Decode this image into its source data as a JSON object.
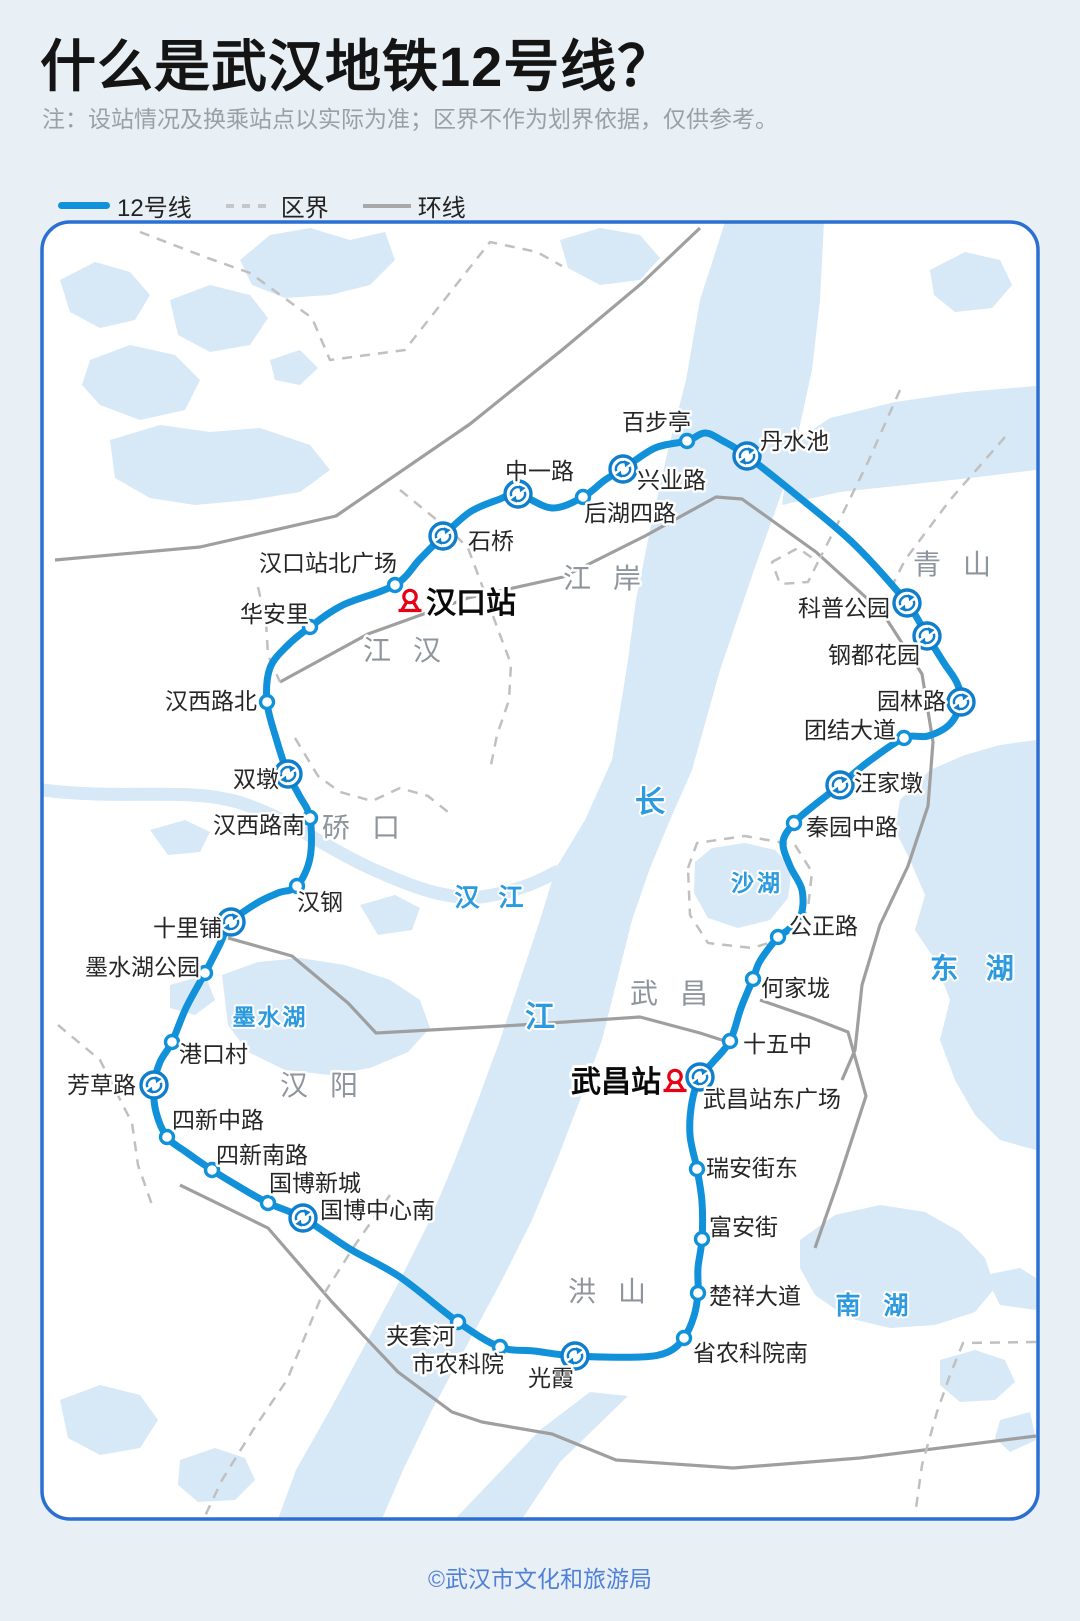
{
  "page": {
    "width": 1080,
    "height": 1621
  },
  "header": {
    "title": "什么是武汉地铁12号线？",
    "note": "注：设站情况及换乘站点以实际为准；区界不作为划界依据，仅供参考。"
  },
  "legend": {
    "items": [
      {
        "label": "12号线",
        "swatch": "line"
      },
      {
        "label": "区界",
        "swatch": "dashed"
      },
      {
        "label": "环线",
        "swatch": "ring-road"
      }
    ]
  },
  "footer": {
    "credit": "©武汉市文化和旅游局"
  },
  "colors": {
    "line": "#1191d9",
    "transfer_icon": "#0f7ecc",
    "map_border": "#2a6fd1",
    "water": "#d7e8f7",
    "road": "#9f9f9f",
    "boundary_dash": "#c0c0c0",
    "water_label": "#2b9ade",
    "district_label": "#8e959c",
    "railway_red": "#e60113",
    "footer_text": "#4f81d8",
    "background": "#e9f0f5"
  },
  "map": {
    "districts": [
      {
        "name": "江岸",
        "x": 613,
        "y": 588
      },
      {
        "name": "江汉",
        "x": 413,
        "y": 660
      },
      {
        "name": "硚口",
        "x": 372,
        "y": 837
      },
      {
        "name": "汉阳",
        "x": 330,
        "y": 1095
      },
      {
        "name": "武昌",
        "x": 680,
        "y": 1003
      },
      {
        "name": "洪山",
        "x": 618,
        "y": 1301
      },
      {
        "name": "青山",
        "x": 963,
        "y": 574
      }
    ],
    "water_labels": [
      {
        "name": "长",
        "x": 650,
        "y": 812,
        "size": 30,
        "ls": 0
      },
      {
        "name": "江",
        "x": 540,
        "y": 1027,
        "size": 30,
        "ls": 0
      },
      {
        "name": "汉 江",
        "x": 492,
        "y": 906,
        "size": 25,
        "ls": 6
      },
      {
        "name": "沙湖",
        "x": 757,
        "y": 891,
        "size": 23,
        "ls": 3
      },
      {
        "name": "东 湖",
        "x": 977,
        "y": 978,
        "size": 28,
        "ls": 10
      },
      {
        "name": "墨水湖",
        "x": 270,
        "y": 1025,
        "size": 23,
        "ls": 2
      },
      {
        "name": "南 湖",
        "x": 876,
        "y": 1314,
        "size": 25,
        "ls": 8
      }
    ],
    "stations": [
      {
        "n": "汉口站北广场",
        "x": 395,
        "y": 585,
        "t": 0,
        "a": "e",
        "lx": 397,
        "ly": 571
      },
      {
        "n": "石桥",
        "x": 443,
        "y": 536,
        "t": 1,
        "a": "s",
        "lx": 468,
        "ly": 549
      },
      {
        "n": "中一路",
        "x": 518,
        "y": 494,
        "t": 1,
        "a": "s",
        "lx": 505,
        "ly": 479
      },
      {
        "n": "后湖四路",
        "x": 583,
        "y": 497,
        "t": 0,
        "a": "s",
        "lx": 584,
        "ly": 521
      },
      {
        "n": "兴业路",
        "x": 623,
        "y": 469,
        "t": 1,
        "a": "s",
        "lx": 637,
        "ly": 488
      },
      {
        "n": "百步亭",
        "x": 687,
        "y": 441,
        "t": 0,
        "a": "e",
        "lx": 691,
        "ly": 430
      },
      {
        "n": "丹水池",
        "x": 747,
        "y": 456,
        "t": 1,
        "a": "s",
        "lx": 760,
        "ly": 449
      },
      {
        "n": "科普公园",
        "x": 907,
        "y": 603,
        "t": 1,
        "a": "e",
        "lx": 890,
        "ly": 616
      },
      {
        "n": "钢都花园",
        "x": 927,
        "y": 636,
        "t": 1,
        "a": "e",
        "lx": 920,
        "ly": 663
      },
      {
        "n": "园林路",
        "x": 961,
        "y": 702,
        "t": 1,
        "a": "e",
        "lx": 946,
        "ly": 709
      },
      {
        "n": "团结大道",
        "x": 904,
        "y": 738,
        "t": 0,
        "a": "e",
        "lx": 896,
        "ly": 738
      },
      {
        "n": "汪家墩",
        "x": 840,
        "y": 785,
        "t": 1,
        "a": "s",
        "lx": 854,
        "ly": 791
      },
      {
        "n": "秦园中路",
        "x": 794,
        "y": 823,
        "t": 0,
        "a": "s",
        "lx": 806,
        "ly": 835
      },
      {
        "n": "公正路",
        "x": 778,
        "y": 937,
        "t": 0,
        "a": "s",
        "lx": 789,
        "ly": 934
      },
      {
        "n": "何家垅",
        "x": 753,
        "y": 979,
        "t": 0,
        "a": "s",
        "lx": 761,
        "ly": 996
      },
      {
        "n": "十五中",
        "x": 730,
        "y": 1041,
        "t": 0,
        "a": "s",
        "lx": 743,
        "ly": 1052
      },
      {
        "n": "武昌站东广场",
        "x": 700,
        "y": 1077,
        "t": 1,
        "a": "s",
        "lx": 703,
        "ly": 1107
      },
      {
        "n": "瑞安街东",
        "x": 697,
        "y": 1169,
        "t": 0,
        "a": "s",
        "lx": 706,
        "ly": 1176
      },
      {
        "n": "富安街",
        "x": 702,
        "y": 1239,
        "t": 0,
        "a": "s",
        "lx": 709,
        "ly": 1235
      },
      {
        "n": "楚祥大道",
        "x": 698,
        "y": 1293,
        "t": 0,
        "a": "s",
        "lx": 709,
        "ly": 1304
      },
      {
        "n": "省农科院南",
        "x": 684,
        "y": 1338,
        "t": 0,
        "a": "s",
        "lx": 693,
        "ly": 1361
      },
      {
        "n": "光霞",
        "x": 575,
        "y": 1356,
        "t": 1,
        "a": "m",
        "lx": 551,
        "ly": 1386
      },
      {
        "n": "市农科院",
        "x": 500,
        "y": 1347,
        "t": 0,
        "a": "e",
        "lx": 504,
        "ly": 1372
      },
      {
        "n": "夹套河",
        "x": 458,
        "y": 1322,
        "t": 0,
        "a": "e",
        "lx": 455,
        "ly": 1344
      },
      {
        "n": "国博中心南",
        "x": 303,
        "y": 1218,
        "t": 1,
        "a": "s",
        "lx": 320,
        "ly": 1218
      },
      {
        "n": "国博新城",
        "x": 268,
        "y": 1203,
        "t": 0,
        "a": "s",
        "lx": 269,
        "ly": 1191
      },
      {
        "n": "四新南路",
        "x": 212,
        "y": 1170,
        "t": 0,
        "a": "s",
        "lx": 216,
        "ly": 1163
      },
      {
        "n": "四新中路",
        "x": 167,
        "y": 1137,
        "t": 0,
        "a": "s",
        "lx": 172,
        "ly": 1128
      },
      {
        "n": "芳草路",
        "x": 154,
        "y": 1085,
        "t": 1,
        "a": "e",
        "lx": 136,
        "ly": 1093
      },
      {
        "n": "港口村",
        "x": 172,
        "y": 1042,
        "t": 0,
        "a": "s",
        "lx": 179,
        "ly": 1062
      },
      {
        "n": "墨水湖公园",
        "x": 205,
        "y": 973,
        "t": 0,
        "a": "e",
        "lx": 200,
        "ly": 975
      },
      {
        "n": "十里铺",
        "x": 231,
        "y": 922,
        "t": 1,
        "a": "e",
        "lx": 222,
        "ly": 936
      },
      {
        "n": "汉钢",
        "x": 297,
        "y": 886,
        "t": 0,
        "a": "s",
        "lx": 297,
        "ly": 910
      },
      {
        "n": "汉西路南",
        "x": 310,
        "y": 818,
        "t": 0,
        "a": "e",
        "lx": 305,
        "ly": 833
      },
      {
        "n": "双墩",
        "x": 288,
        "y": 774,
        "t": 1,
        "a": "e",
        "lx": 279,
        "ly": 787
      },
      {
        "n": "汉西路北",
        "x": 267,
        "y": 702,
        "t": 0,
        "a": "e",
        "lx": 257,
        "ly": 709
      },
      {
        "n": "华安里",
        "x": 310,
        "y": 627,
        "t": 0,
        "a": "e",
        "lx": 309,
        "ly": 622
      }
    ],
    "railway_stations": [
      {
        "name": "汉口站",
        "icon_x": 410,
        "icon_y": 601,
        "tx": 426,
        "ty": 613,
        "a": "s"
      },
      {
        "name": "武昌站",
        "icon_x": 675,
        "icon_y": 1081,
        "tx": 661,
        "ty": 1092,
        "a": "e"
      }
    ],
    "route_points": [
      [
        310,
        627
      ],
      [
        343,
        605
      ],
      [
        395,
        585
      ],
      [
        420,
        559
      ],
      [
        443,
        536
      ],
      [
        470,
        512
      ],
      [
        500,
        499
      ],
      [
        518,
        494
      ],
      [
        552,
        508
      ],
      [
        583,
        497
      ],
      [
        605,
        480
      ],
      [
        623,
        469
      ],
      [
        655,
        448
      ],
      [
        687,
        441
      ],
      [
        705,
        433
      ],
      [
        723,
        441
      ],
      [
        747,
        456
      ],
      [
        800,
        498
      ],
      [
        855,
        545
      ],
      [
        907,
        603
      ],
      [
        927,
        636
      ],
      [
        944,
        663
      ],
      [
        957,
        683
      ],
      [
        961,
        702
      ],
      [
        950,
        724
      ],
      [
        928,
        736
      ],
      [
        904,
        738
      ],
      [
        868,
        762
      ],
      [
        840,
        785
      ],
      [
        812,
        807
      ],
      [
        794,
        823
      ],
      [
        783,
        842
      ],
      [
        790,
        866
      ],
      [
        802,
        890
      ],
      [
        801,
        915
      ],
      [
        788,
        930
      ],
      [
        778,
        937
      ],
      [
        760,
        961
      ],
      [
        753,
        979
      ],
      [
        741,
        1008
      ],
      [
        730,
        1041
      ],
      [
        713,
        1062
      ],
      [
        700,
        1077
      ],
      [
        692,
        1102
      ],
      [
        690,
        1135
      ],
      [
        697,
        1169
      ],
      [
        702,
        1202
      ],
      [
        702,
        1239
      ],
      [
        698,
        1268
      ],
      [
        698,
        1293
      ],
      [
        694,
        1316
      ],
      [
        684,
        1338
      ],
      [
        668,
        1352
      ],
      [
        640,
        1357
      ],
      [
        575,
        1356
      ],
      [
        534,
        1351
      ],
      [
        500,
        1347
      ],
      [
        458,
        1322
      ],
      [
        400,
        1277
      ],
      [
        350,
        1249
      ],
      [
        303,
        1218
      ],
      [
        268,
        1203
      ],
      [
        238,
        1186
      ],
      [
        212,
        1170
      ],
      [
        186,
        1152
      ],
      [
        167,
        1137
      ],
      [
        156,
        1112
      ],
      [
        154,
        1085
      ],
      [
        160,
        1062
      ],
      [
        172,
        1042
      ],
      [
        186,
        1008
      ],
      [
        205,
        973
      ],
      [
        220,
        944
      ],
      [
        231,
        922
      ],
      [
        257,
        903
      ],
      [
        278,
        893
      ],
      [
        297,
        886
      ],
      [
        310,
        858
      ],
      [
        310,
        818
      ],
      [
        299,
        795
      ],
      [
        288,
        774
      ],
      [
        276,
        738
      ],
      [
        267,
        702
      ],
      [
        270,
        668
      ],
      [
        288,
        645
      ]
    ]
  }
}
